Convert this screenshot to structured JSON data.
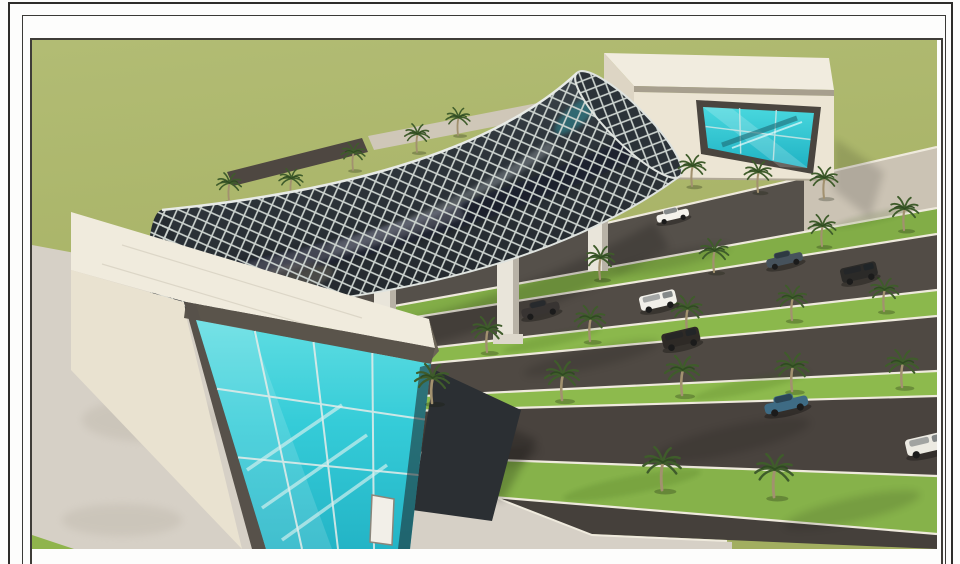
{
  "image": {
    "type": "3d-architectural-rendering",
    "title": "Aerial concept render: tubular diagrid pedestrian skybridge over a palm-lined multi-lane boulevard, linking two cream terminal buildings with turquoise glass curtain walls",
    "style": "presentation board with double ruled page border",
    "visible_text": "none"
  },
  "palette": {
    "page": "#fdfdfc",
    "border_ink": "#2e2d2b",
    "field_olive": "#a9b468",
    "median_grass": "#8cb84c",
    "asphalt": "#4f4943",
    "curb_white": "#efeadd",
    "plaza_concrete": "#cbc3b4",
    "pavement_concrete": "#d6d0c6",
    "building_cream": "#ece5d4",
    "roof_white": "#f1ecdf",
    "fascia_dark": "#5a544b",
    "glass_turquoise": "#35d0da",
    "tube_glazing": "#2e353b",
    "tube_lattice": "#cdd4d0",
    "palm_frond": "#3f5c2b",
    "palm_trunk": "#a2916f"
  },
  "scene_inventory": {
    "buildings": [
      {
        "name": "west-terminal",
        "walls": "cream",
        "facade": "turquoise glass curtain wall with staircase inside",
        "roof": "flat white slab"
      },
      {
        "name": "east-terminal",
        "walls": "cream",
        "facade": "slanted turquoise glass wall with escalator",
        "roof": "flat white slab"
      }
    ],
    "bridge": {
      "form": "curved tube",
      "cladding": "diamond diagrid lattice over dark reflective glazing",
      "piers": 3
    },
    "road": {
      "lanes": 5,
      "medians": "grass strips with date palms",
      "markings": "white edge lines"
    },
    "vehicles": [
      {
        "type": "hatchback",
        "color": "white"
      },
      {
        "type": "sedan",
        "color": "slate blue"
      },
      {
        "type": "suv",
        "color": "black"
      },
      {
        "type": "sedan",
        "color": "dark gray"
      },
      {
        "type": "minivan",
        "color": "white"
      },
      {
        "type": "suv",
        "color": "black"
      },
      {
        "type": "sedan",
        "color": "steel blue"
      },
      {
        "type": "van",
        "color": "white"
      }
    ],
    "palm_trees": 24
  }
}
